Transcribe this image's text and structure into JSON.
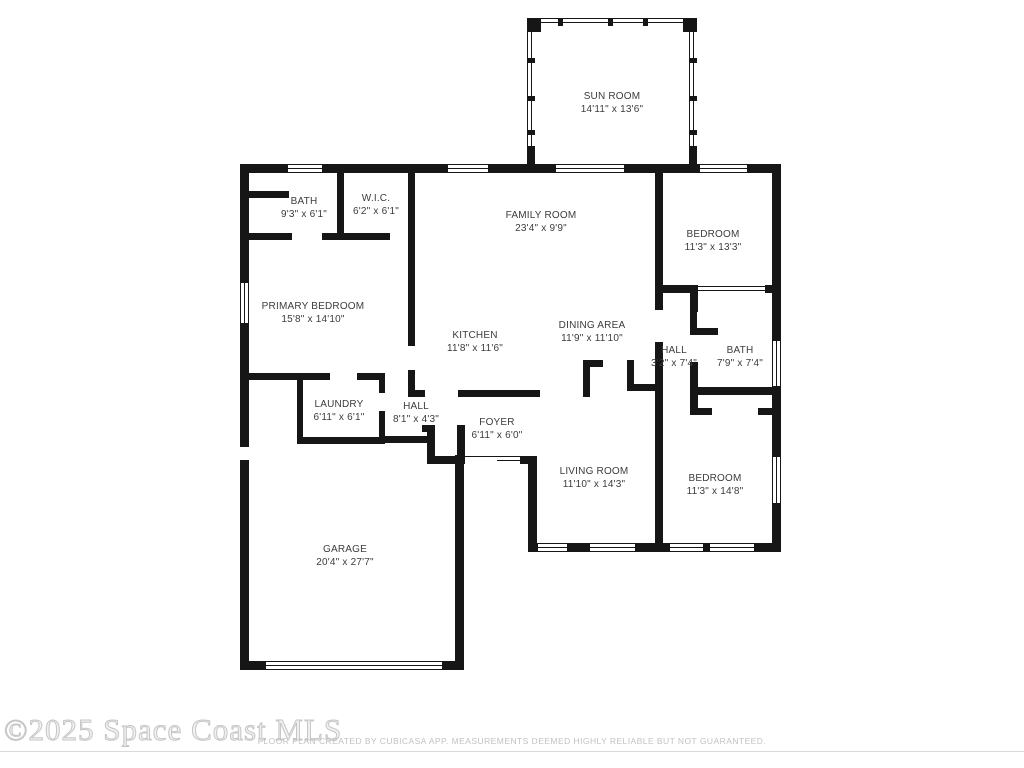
{
  "colors": {
    "wall": "#161616",
    "label": "#3c3c3c",
    "watermark": "#c6c6c6",
    "footer": "#c2c2c2"
  },
  "watermark": {
    "text": "©2025 Space Coast MLS"
  },
  "footer": {
    "text": "FLOOR PLAN CREATED BY CUBICASA APP. MEASUREMENTS DEEMED HIGHLY RELIABLE BUT NOT GUARANTEED."
  },
  "rooms": [
    {
      "id": "sun-room",
      "name": "SUN ROOM",
      "dims": "14'11\" x 13'6\""
    },
    {
      "id": "bath-upper",
      "name": "BATH",
      "dims": "9'3\" x 6'1\""
    },
    {
      "id": "wic",
      "name": "W.I.C.",
      "dims": "6'2\" x 6'1\""
    },
    {
      "id": "family-room",
      "name": "FAMILY ROOM",
      "dims": "23'4\" x 9'9\""
    },
    {
      "id": "bedroom-upper",
      "name": "BEDROOM",
      "dims": "11'3\" x 13'3\""
    },
    {
      "id": "primary-bedroom",
      "name": "PRIMARY BEDROOM",
      "dims": "15'8\" x 14'10\""
    },
    {
      "id": "kitchen",
      "name": "KITCHEN",
      "dims": "11'8\" x 11'6\""
    },
    {
      "id": "dining-area",
      "name": "DINING AREA",
      "dims": "11'9\" x 11'10\""
    },
    {
      "id": "hall-east",
      "name": "HALL",
      "dims": "3'2\" x 7'4\""
    },
    {
      "id": "bath-east",
      "name": "BATH",
      "dims": "7'9\" x 7'4\""
    },
    {
      "id": "laundry",
      "name": "LAUNDRY",
      "dims": "6'11\" x 6'1\""
    },
    {
      "id": "hall-center",
      "name": "HALL",
      "dims": "8'1\" x 4'3\""
    },
    {
      "id": "foyer",
      "name": "FOYER",
      "dims": "6'11\" x 6'0\""
    },
    {
      "id": "living-room",
      "name": "LIVING ROOM",
      "dims": "11'10\" x 14'3\""
    },
    {
      "id": "bedroom-lower",
      "name": "BEDROOM",
      "dims": "11'3\" x 14'8\""
    },
    {
      "id": "garage",
      "name": "GARAGE",
      "dims": "20'4\" x 27'7\""
    }
  ]
}
